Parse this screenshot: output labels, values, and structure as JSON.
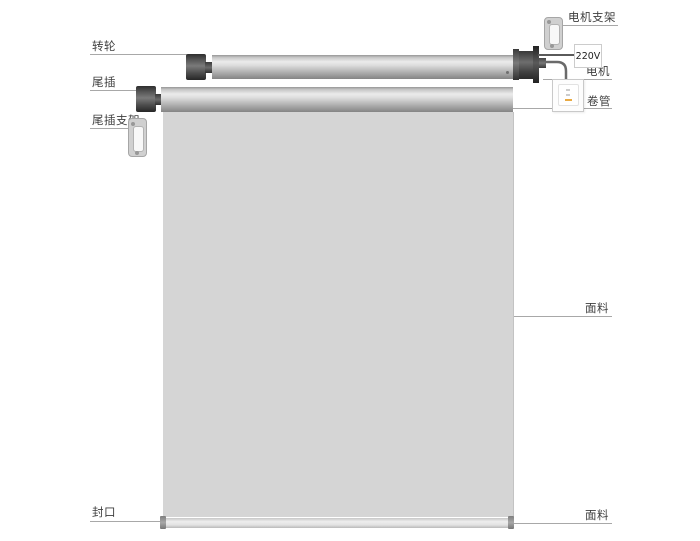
{
  "diagram": {
    "type": "exploded-parts-diagram",
    "subject": "motorized roller blind / electric curtain components",
    "labels": {
      "idler_wheel": "转轮",
      "tail_plug": "尾插",
      "tail_plug_bracket": "尾插支架",
      "motor_bracket": "电机支架",
      "voltage": "220V",
      "motor": "电机",
      "roller_tube": "卷管",
      "fabric_middle": "面料",
      "fabric_bottom": "面料",
      "bottom_seal": "封口"
    },
    "colors": {
      "background": "#ffffff",
      "label_text": "#3f3f3f",
      "leader_line": "#a8a8a8",
      "fabric_fill": "#d5d5d5",
      "tube_highlight": "#ebebeb",
      "tube_shadow": "#848484",
      "end_cap_dark": "#2e2e2e",
      "bracket_fill": "#d0d0d0",
      "switch_accent_orange": "#e9aa43",
      "voltage_connector": "#5a5a5a"
    }
  }
}
